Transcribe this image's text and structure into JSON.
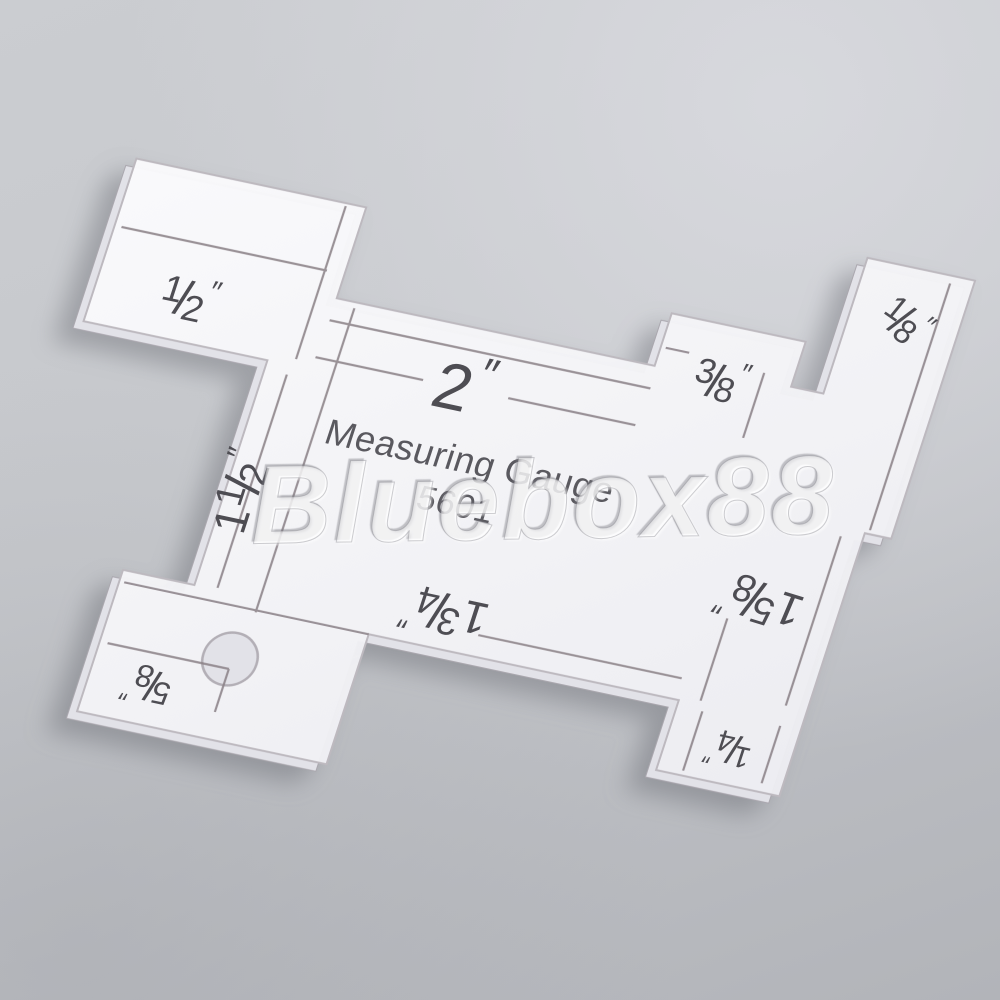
{
  "scene": "transparent acrylic quilting seam measuring gauge lying on a gray studio background, photographed at an angle",
  "background": {
    "top_color": "#cbcdd1",
    "bottom_color": "#b2b4b9"
  },
  "watermark": {
    "text": "Bluebox88"
  },
  "gauge": {
    "title_line1": "Measuring Gauge",
    "title_line2": "5601",
    "material_color": "#f4f4f7",
    "engraving_color": "#8a8086",
    "label_color": "#4e4d53",
    "labels": [
      {
        "id": "half",
        "whole": "",
        "num": "1",
        "den": "2",
        "unit": "″"
      },
      {
        "id": "two",
        "whole": "2",
        "num": "",
        "den": "",
        "unit": "″"
      },
      {
        "id": "three-eighths",
        "whole": "",
        "num": "3",
        "den": "8",
        "unit": "″"
      },
      {
        "id": "one-eighth",
        "whole": "",
        "num": "1",
        "den": "8",
        "unit": "″"
      },
      {
        "id": "one-and-a-half",
        "whole": "1",
        "num": "1",
        "den": "2",
        "unit": "″"
      },
      {
        "id": "one-five-eighths",
        "whole": "1",
        "num": "5",
        "den": "8",
        "unit": "″"
      },
      {
        "id": "one-three-quarters",
        "whole": "1",
        "num": "3",
        "den": "4",
        "unit": "″"
      },
      {
        "id": "five-eighths",
        "whole": "",
        "num": "5",
        "den": "8",
        "unit": "″"
      },
      {
        "id": "one-quarter",
        "whole": "",
        "num": "1",
        "den": "4",
        "unit": "″"
      }
    ]
  }
}
